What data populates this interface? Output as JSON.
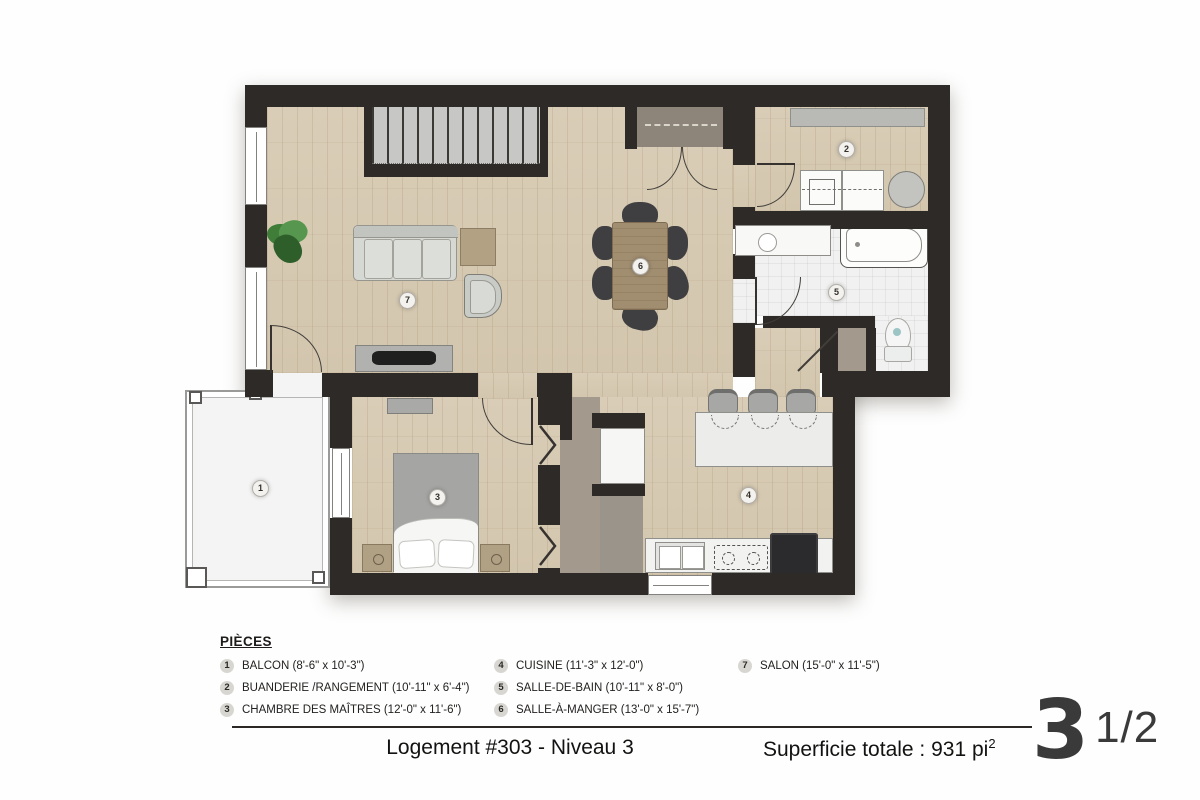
{
  "plan": {
    "badges": {
      "b1": "1",
      "b2": "2",
      "b3": "3",
      "b4": "4",
      "b5": "5",
      "b6": "6",
      "b7": "7"
    }
  },
  "legend": {
    "heading": "PIÈCES",
    "items": [
      {
        "num": "1",
        "label": "BALCON (8'-6\" x 10'-3\")"
      },
      {
        "num": "2",
        "label": "BUANDERIE /RANGEMENT (10'-11\" x 6'-4\")"
      },
      {
        "num": "3",
        "label": "CHAMBRE DES MAÎTRES (12'-0\" x 11'-6\")"
      },
      {
        "num": "4",
        "label": "CUISINE (11'-3\" x 12'-0\")"
      },
      {
        "num": "5",
        "label": "SALLE-DE-BAIN (10'-11\" x 8'-0\")"
      },
      {
        "num": "6",
        "label": "SALLE-À-MANGER (13'-0\" x 15'-7\")"
      },
      {
        "num": "7",
        "label": "SALON (15'-0\" x 11'-5\")"
      }
    ]
  },
  "footer": {
    "unit_title": "Logement #303 - Niveau 3",
    "area_text": "Superficie totale : 931 pi",
    "area_sup": "2",
    "type_number": "3",
    "type_fraction": "1/2"
  }
}
